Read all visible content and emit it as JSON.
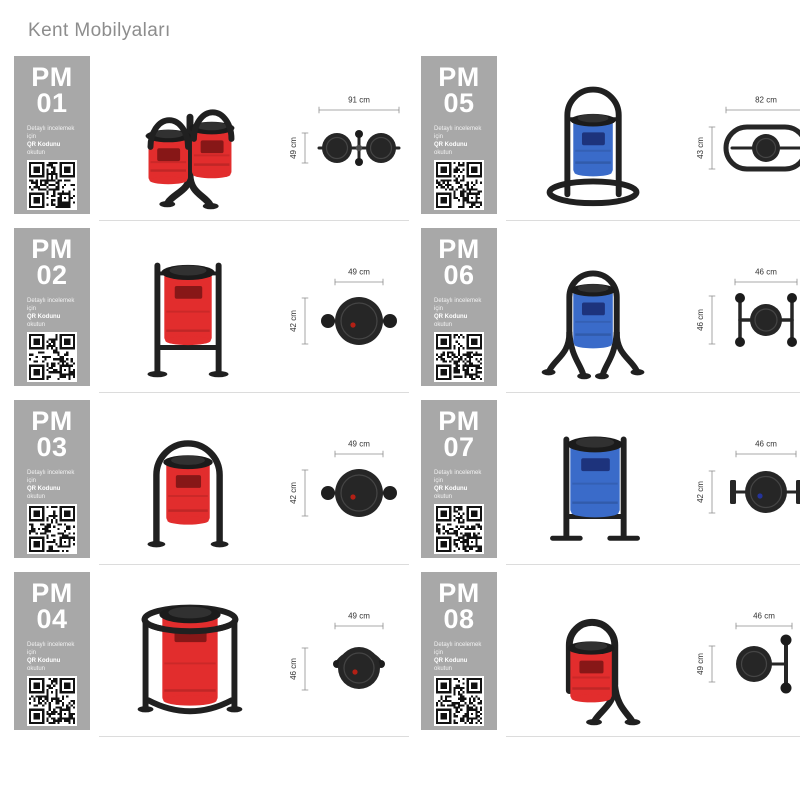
{
  "page": {
    "title": "Kent Mobilyaları"
  },
  "colors": {
    "card_bg": "#a8a8a8",
    "card_text": "#ffffff",
    "frame": "#202020",
    "lid": "#1b1b1b",
    "red": "#e22d2d",
    "blue": "#3a6bc9",
    "dim_line": "#8f8f8f",
    "dim_text": "#333333",
    "divider": "#dcdcdc",
    "header_text": "#8d8d8d",
    "topview_dark": "#262626"
  },
  "icons": {
    "qr": "qr-code-pattern"
  },
  "qr_note": {
    "line1": "Detaylı incelemek için",
    "bold": "QR Kodunu",
    "rest": "okutun"
  },
  "products": [
    {
      "code_line1": "PM",
      "code_line2": "01",
      "dim_width": "91 cm",
      "dim_height": "49 cm",
      "bin_style": "double-hanging",
      "bin_color": "red",
      "top_view": "twin",
      "dot": null
    },
    {
      "code_line1": "PM",
      "code_line2": "02",
      "dim_width": "49 cm",
      "dim_height": "42 cm",
      "bin_style": "two-post",
      "bin_color": "red",
      "top_view": "knobs",
      "dot": "red"
    },
    {
      "code_line1": "PM",
      "code_line2": "03",
      "dim_width": "49 cm",
      "dim_height": "42 cm",
      "bin_style": "arch-two-leg",
      "bin_color": "red",
      "top_view": "knobs",
      "dot": "red"
    },
    {
      "code_line1": "PM",
      "code_line2": "04",
      "dim_width": "49 cm",
      "dim_height": "46 cm",
      "bin_style": "ring-frame",
      "bin_color": "red",
      "top_view": "arc",
      "dot": "red"
    },
    {
      "code_line1": "PM",
      "code_line2": "05",
      "dim_width": "82 cm",
      "dim_height": "43 cm",
      "bin_style": "oval-base",
      "bin_color": "blue",
      "top_view": "stadium",
      "dot": null
    },
    {
      "code_line1": "PM",
      "code_line2": "06",
      "dim_width": "46 cm",
      "dim_height": "46 cm",
      "bin_style": "arch-four-leg",
      "bin_color": "blue",
      "top_view": "hframe",
      "dot": null
    },
    {
      "code_line1": "PM",
      "code_line2": "07",
      "dim_width": "46 cm",
      "dim_height": "42 cm",
      "bin_style": "two-post-flat",
      "bin_color": "blue",
      "top_view": "plates",
      "dot": "blue"
    },
    {
      "code_line1": "PM",
      "code_line2": "08",
      "dim_width": "46 cm",
      "dim_height": "49 cm",
      "bin_style": "hook",
      "bin_color": "red",
      "top_view": "sidebar",
      "dot": null
    }
  ]
}
